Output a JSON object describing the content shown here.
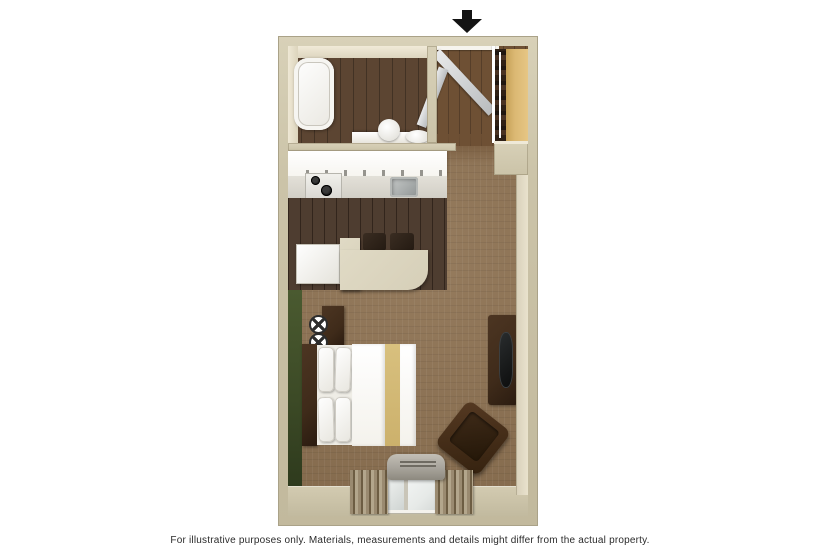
{
  "caption": "For illustrative purposes only.  Materials, measurements and details might differ from the actual property.",
  "floorplan": {
    "type": "studio-suite-3d-floor-plan",
    "entrance": {
      "indicator": "black-down-arrow",
      "location": "top-right-of-plan"
    },
    "rooms": [
      {
        "name": "bathroom",
        "position": "top-left",
        "features": [
          "bathtub",
          "toilet",
          "sink",
          "vanity",
          "bathroom-door"
        ]
      },
      {
        "name": "entry",
        "position": "top-right",
        "features": [
          "entry-door",
          "closet-with-hanging-clothes",
          "closet-shelf"
        ]
      },
      {
        "name": "kitchen",
        "position": "middle-left",
        "features": [
          "upper-cabinets",
          "stovetop-two-burners",
          "kitchen-sink",
          "refrigerator",
          "l-shaped-bar-counter",
          "two-bar-stools"
        ]
      },
      {
        "name": "living-sleeping-area",
        "position": "bottom",
        "features": [
          "green-accent-wall",
          "two-wall-sconces",
          "nightstand",
          "bed-with-headboard-pillows-gold-runner",
          "tv-stand",
          "flat-tv",
          "armchair",
          "ptac-ac-unit",
          "window-with-curtains"
        ]
      }
    ],
    "colors": {
      "wall": "#cbc3a8",
      "wall_edge": "#aaa288",
      "carpet": "#8e7252",
      "wood_floor_dark": "#473528",
      "wood_floor_bath": "#5c4532",
      "wood_floor_entry": "#6e5034",
      "accent_wall_green": "#3c4a26",
      "closet_tan": "#dbb873",
      "counter_cream": "#d6cfb8",
      "cabinet_white": "#f7f5f0",
      "bedding_white": "#f4f2ec",
      "bed_stripe_gold": "#ccb16c",
      "furniture_dark": "#3f2b1a",
      "ac_gray": "#a7a39a",
      "interior_cream": "#eae2d0",
      "caption_color": "#2b2b2b"
    }
  }
}
